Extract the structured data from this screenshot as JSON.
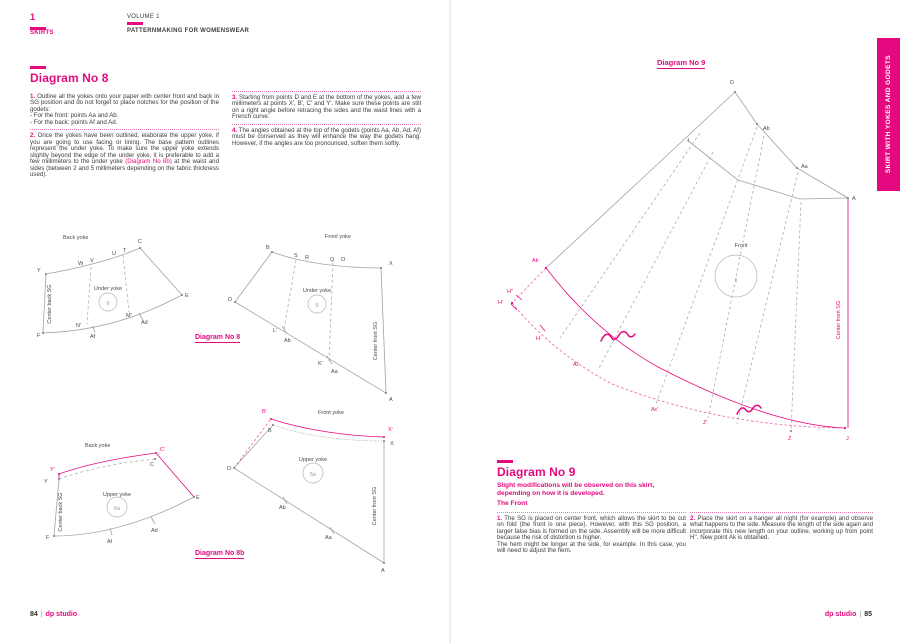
{
  "header": {
    "chapter_num": "1",
    "chapter_title": "SKIRTS",
    "volume": "VOLUME 1",
    "book_title": "PATTERNMAKING FOR WOMENSWEAR"
  },
  "side_tab": {
    "label": "SKIRT WITH YOKES AND GODETS"
  },
  "colors": {
    "accent_pink": "#e4097e",
    "line_gray": "#a3a3a3"
  },
  "left_page": {
    "heading": "Diagram No 8",
    "item1_num": "1.",
    "item1_text": "Outline all the yokes onto your paper with center front and back in SG position and do not forget to place notches for the position of the godets:\n- For the front: points Aa and Ab.\n- For the back: points Af and Ad.",
    "item2_num": "2.",
    "item2_pre": "Once the yokes have been outlined, elaborate the upper yoke, if you are going to use facing or lining. The base pattern outlines represent the under yoke. To make sure the upper yoke extends slightly beyond the edge of the under yoke, it is preferable to add a few millimeters to the under yoke ",
    "item2_link": "(Diagram No 8b)",
    "item2_post": " at the waist and sides (between 2 and 5 millimeters depending on the fabric thickness used).",
    "item3_num": "3.",
    "item3_text": "Starting from points D and E at the bottom of the yokes, add a few millimeters at points X', B', C' and Y'. Make sure these points are still on a right angle before retracing the sides and the waist lines with a French curve.",
    "item4_num": "4.",
    "item4_text": "The angles obtained at the top of the godets (points Aa, Ab, Ad, Af) must be conserved as they will enhance the way the godets hang. However, if the angles are too pronounced, soften them softly.",
    "caption_no8": "Diagram No 8",
    "caption_no8b": "Diagram No 8b",
    "footer_page": "84",
    "footer_brand": "dp studio"
  },
  "right_page": {
    "caption_no9": "Diagram No 9",
    "heading": "Diagram No 9",
    "subtitle": "Slight modifications will be observed on this skirt,\ndepending on how it is developed.",
    "subheading": "The Front",
    "item1_num": "1.",
    "item1_text": "The SG is placed on center front, which allows the skirt to be cut on fold (the front is one piece). However, with this SG position, a larger false bias is formed on the side. Assembly will be more difficult because the risk of distortion is higher.\nThe hem might be longer at the side, for example. In this case, you will need to adjust the hem.",
    "item2_num": "2.",
    "item2_text": "Place the skirt on a hanger all night (for example) and observe what happens to the side. Measure the length of the side again and incorporate this new length on your outline, working up from point H''. New point Ak is obtained.",
    "footer_page": "85",
    "footer_brand": "dp studio"
  },
  "diagram_labels": [
    {
      "x": 63,
      "y": 239,
      "t": "Back yoke",
      "c": "d",
      "fs": 5.8
    },
    {
      "x": 37,
      "y": 272,
      "t": "Y",
      "c": "d"
    },
    {
      "x": 78,
      "y": 265,
      "t": "W",
      "c": "d"
    },
    {
      "x": 90,
      "y": 262,
      "t": "V",
      "c": "d"
    },
    {
      "x": 112,
      "y": 255,
      "t": "U",
      "c": "d"
    },
    {
      "x": 123,
      "y": 252,
      "t": "T",
      "c": "d"
    },
    {
      "x": 138,
      "y": 243,
      "t": "C",
      "c": "d"
    },
    {
      "x": 185,
      "y": 297,
      "t": "E",
      "c": "d"
    },
    {
      "x": 141,
      "y": 324,
      "t": "Ad",
      "c": "d"
    },
    {
      "x": 126,
      "y": 317,
      "t": "M'",
      "c": "d"
    },
    {
      "x": 76,
      "y": 327,
      "t": "N'",
      "c": "d"
    },
    {
      "x": 90,
      "y": 338,
      "t": "Af",
      "c": "d"
    },
    {
      "x": 37,
      "y": 337,
      "t": "F",
      "c": "d"
    },
    {
      "x": 51,
      "y": 304,
      "t": "Center back SG",
      "c": "d",
      "fs": 4.8,
      "a": "m",
      "r": 1
    },
    {
      "x": 108,
      "y": 290,
      "t": "Under yoke",
      "c": "d",
      "fs": 5.8,
      "a": "m"
    },
    {
      "x": 108,
      "y": 305,
      "t": "6",
      "c": "g",
      "fs": 7.5,
      "a": "m"
    },
    {
      "x": 325,
      "y": 238,
      "t": "Front yoke",
      "c": "d",
      "fs": 5.8
    },
    {
      "x": 266,
      "y": 249,
      "t": "B",
      "c": "d"
    },
    {
      "x": 294,
      "y": 257,
      "t": "S",
      "c": "d"
    },
    {
      "x": 305,
      "y": 259,
      "t": "R",
      "c": "d"
    },
    {
      "x": 330,
      "y": 261,
      "t": "Q",
      "c": "d"
    },
    {
      "x": 341,
      "y": 261,
      "t": "O",
      "c": "d"
    },
    {
      "x": 389,
      "y": 265,
      "t": "X",
      "c": "d"
    },
    {
      "x": 228,
      "y": 301,
      "t": "D",
      "c": "d"
    },
    {
      "x": 273,
      "y": 332,
      "t": "L'",
      "c": "d"
    },
    {
      "x": 284,
      "y": 342,
      "t": "Ab",
      "c": "d"
    },
    {
      "x": 318,
      "y": 365,
      "t": "K'",
      "c": "d"
    },
    {
      "x": 331,
      "y": 373,
      "t": "Aa",
      "c": "d"
    },
    {
      "x": 389,
      "y": 401,
      "t": "A",
      "c": "d"
    },
    {
      "x": 377,
      "y": 341,
      "t": "Center front SG",
      "c": "d",
      "fs": 4.8,
      "a": "m",
      "r": 1
    },
    {
      "x": 317,
      "y": 292,
      "t": "Under yoke",
      "c": "d",
      "fs": 5.8,
      "a": "m"
    },
    {
      "x": 317,
      "y": 307,
      "t": "5",
      "c": "g",
      "fs": 7.5,
      "a": "m"
    },
    {
      "x": 85,
      "y": 447,
      "t": "Back yoke",
      "c": "d",
      "fs": 5.8
    },
    {
      "x": 50,
      "y": 471,
      "t": "Y'",
      "c": "p"
    },
    {
      "x": 44,
      "y": 483,
      "t": "Y",
      "c": "d"
    },
    {
      "x": 160,
      "y": 451,
      "t": "C'",
      "c": "p"
    },
    {
      "x": 150,
      "y": 466,
      "t": "C",
      "c": "d"
    },
    {
      "x": 196,
      "y": 499,
      "t": "E",
      "c": "d"
    },
    {
      "x": 151,
      "y": 532,
      "t": "Ad",
      "c": "d"
    },
    {
      "x": 107,
      "y": 543,
      "t": "Af",
      "c": "d"
    },
    {
      "x": 46,
      "y": 539,
      "t": "F",
      "c": "d"
    },
    {
      "x": 62,
      "y": 512,
      "t": "Center back SG",
      "c": "d",
      "fs": 4.8,
      "a": "m",
      "r": 1
    },
    {
      "x": 117,
      "y": 496,
      "t": "Upper yoke",
      "c": "d",
      "fs": 5.8,
      "a": "m"
    },
    {
      "x": 117,
      "y": 510,
      "t": "6a",
      "c": "g",
      "fs": 7.5,
      "a": "m"
    },
    {
      "x": 318,
      "y": 414,
      "t": "Front yoke",
      "c": "d",
      "fs": 5.8
    },
    {
      "x": 262,
      "y": 413,
      "t": "B'",
      "c": "p"
    },
    {
      "x": 268,
      "y": 432,
      "t": "B",
      "c": "d"
    },
    {
      "x": 388,
      "y": 431,
      "t": "X'",
      "c": "p"
    },
    {
      "x": 390,
      "y": 445,
      "t": "X",
      "c": "d"
    },
    {
      "x": 227,
      "y": 470,
      "t": "D",
      "c": "d"
    },
    {
      "x": 279,
      "y": 509,
      "t": "Ab",
      "c": "d"
    },
    {
      "x": 325,
      "y": 539,
      "t": "Aa",
      "c": "d"
    },
    {
      "x": 381,
      "y": 572,
      "t": "A",
      "c": "d"
    },
    {
      "x": 376,
      "y": 506,
      "t": "Center front SG",
      "c": "d",
      "fs": 4.8,
      "a": "m",
      "r": 1
    },
    {
      "x": 313,
      "y": 461,
      "t": "Upper yoke",
      "c": "d",
      "fs": 5.8,
      "a": "m"
    },
    {
      "x": 313,
      "y": 476,
      "t": "5a",
      "c": "g",
      "fs": 7.5,
      "a": "m"
    },
    {
      "x": 730,
      "y": 84,
      "t": "D",
      "c": "d"
    },
    {
      "x": 688,
      "y": 142,
      "t": "I",
      "c": "d"
    },
    {
      "x": 763,
      "y": 130,
      "t": "Ab",
      "c": "d"
    },
    {
      "x": 801,
      "y": 168,
      "t": "Aa",
      "c": "d"
    },
    {
      "x": 852,
      "y": 200,
      "t": "A",
      "c": "d"
    },
    {
      "x": 741,
      "y": 247,
      "t": "Front",
      "c": "d",
      "fs": 6.2,
      "a": "m"
    },
    {
      "x": 736,
      "y": 282,
      "t": "1",
      "c": "g",
      "fs": 18,
      "a": "m"
    },
    {
      "x": 532,
      "y": 262,
      "t": "Ak",
      "c": "p"
    },
    {
      "x": 507,
      "y": 293,
      "t": "H''",
      "c": "p"
    },
    {
      "x": 498,
      "y": 304,
      "t": "H'",
      "c": "p"
    },
    {
      "x": 536,
      "y": 340,
      "t": "H",
      "c": "p"
    },
    {
      "x": 573,
      "y": 366,
      "t": "Ai'",
      "c": "p"
    },
    {
      "x": 651,
      "y": 411,
      "t": "Ac'",
      "c": "p"
    },
    {
      "x": 703,
      "y": 424,
      "t": "Z'",
      "c": "p"
    },
    {
      "x": 788,
      "y": 440,
      "t": "Z",
      "c": "p"
    },
    {
      "x": 846,
      "y": 440,
      "t": "J",
      "c": "p"
    },
    {
      "x": 840,
      "y": 320,
      "t": "Center front SG",
      "c": "p",
      "fs": 4.8,
      "a": "m",
      "r": 1
    }
  ]
}
